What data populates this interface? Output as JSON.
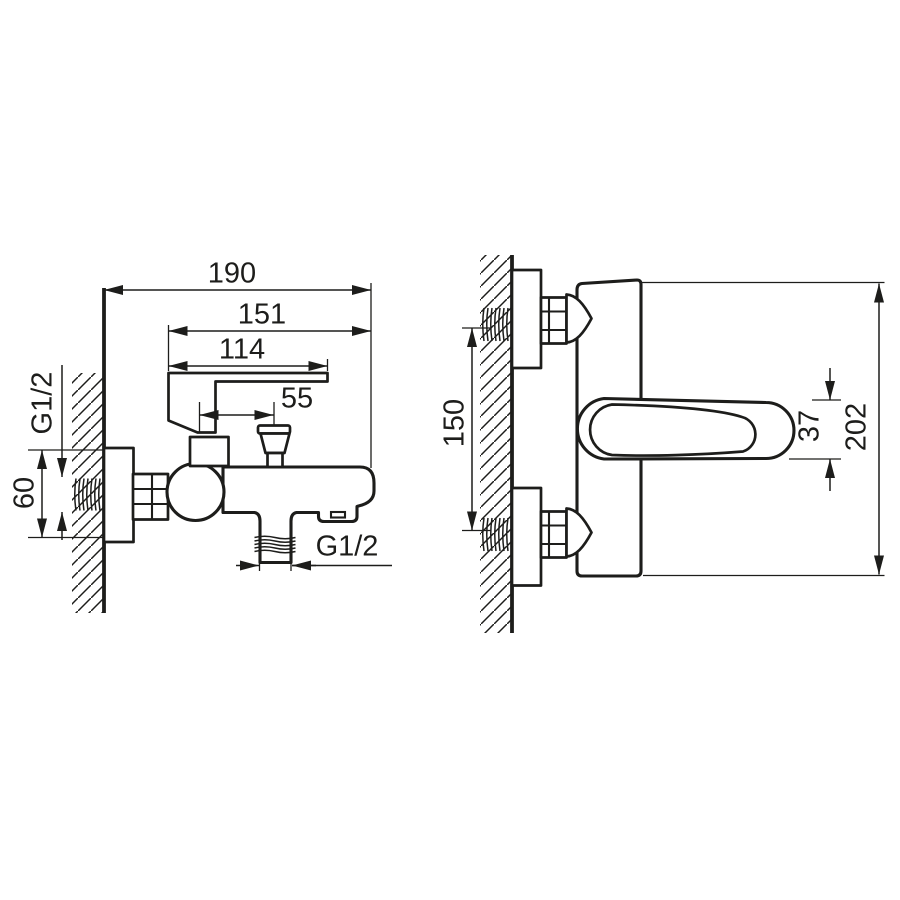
{
  "drawing": {
    "description": "Wall-mounted bath mixer tap dimensional drawing, two views",
    "colors": {
      "line": "#1d1d1b",
      "background": "#ffffff"
    }
  },
  "views": {
    "side": {
      "dims": {
        "overall": "190",
        "upper": "151",
        "handle": "114",
        "diverter": "55",
        "wall_thread": "G1/2",
        "plate": "60",
        "outlet_thread": "G1/2"
      }
    },
    "front": {
      "dims": {
        "spacing": "150",
        "handle_thickness": "37",
        "height": "202"
      }
    }
  }
}
